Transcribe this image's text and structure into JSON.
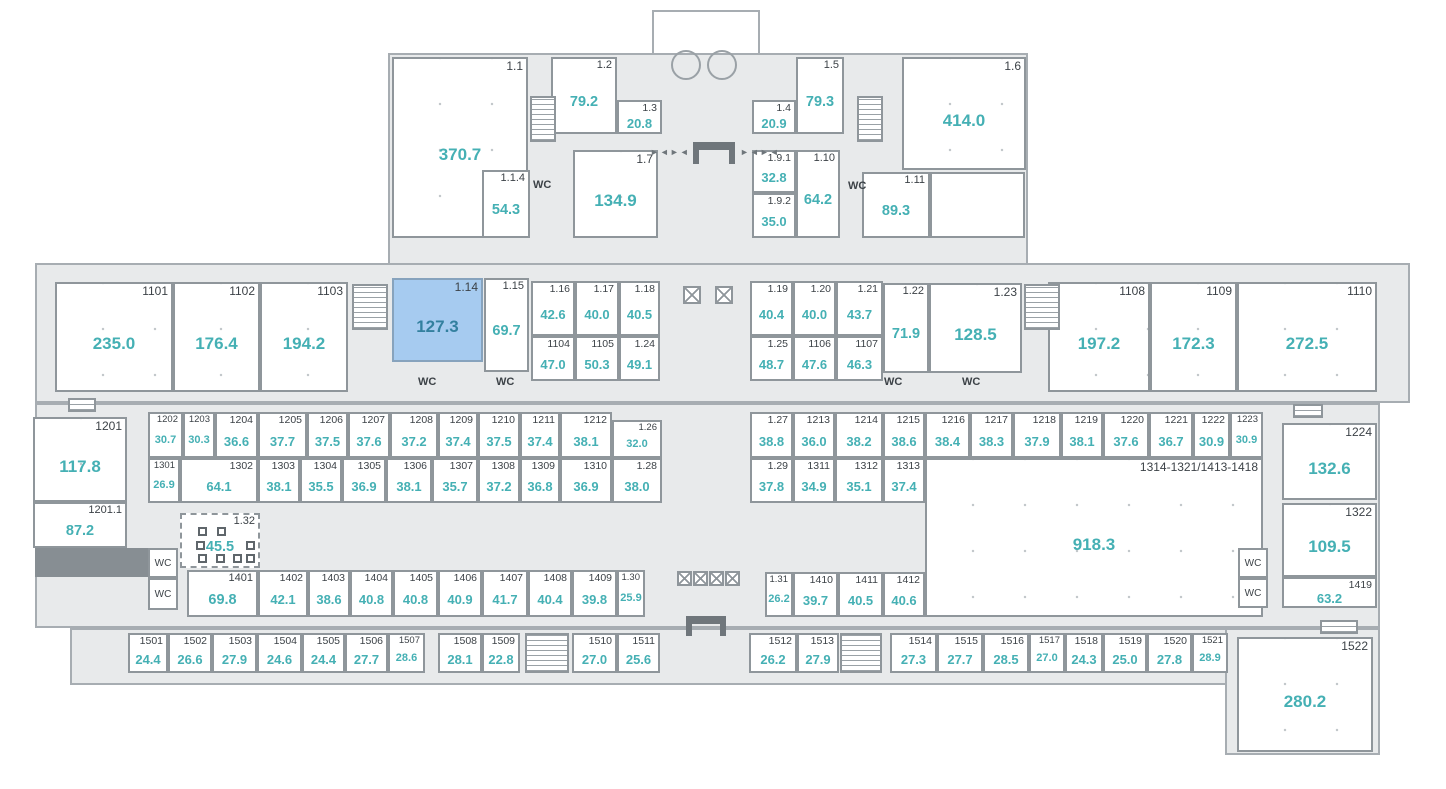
{
  "plan": {
    "title": "floor-plan",
    "colors": {
      "base_fill": "#e8eaeb",
      "wall": "#8f969b",
      "number": "#3c4247",
      "area": "#45b0b4",
      "highlight_fill": "#a6cbf0",
      "highlight_area": "#33809f"
    }
  },
  "base_shapes": [
    {
      "x": 652,
      "y": 10,
      "w": 108,
      "h": 45,
      "white": true
    },
    {
      "x": 388,
      "y": 53,
      "w": 640,
      "h": 212
    },
    {
      "x": 35,
      "y": 263,
      "w": 1375,
      "h": 140
    },
    {
      "x": 35,
      "y": 403,
      "w": 1345,
      "h": 225
    },
    {
      "x": 70,
      "y": 628,
      "w": 1310,
      "h": 57
    },
    {
      "x": 1225,
      "y": 628,
      "w": 155,
      "h": 127
    }
  ],
  "rooms": [
    {
      "id": "1.1",
      "area": "370.7",
      "x": 392,
      "y": 57,
      "w": 136,
      "h": 181,
      "cls": "lg"
    },
    {
      "id": "1.2",
      "area": "79.2",
      "x": 551,
      "y": 57,
      "w": 66,
      "h": 77,
      "cls": "md"
    },
    {
      "id": "1.3",
      "area": "20.8",
      "x": 617,
      "y": 100,
      "w": 45,
      "h": 34,
      "cls": "sm"
    },
    {
      "id": "1.4",
      "area": "20.9",
      "x": 752,
      "y": 100,
      "w": 44,
      "h": 34,
      "cls": "sm"
    },
    {
      "id": "1.5",
      "area": "79.3",
      "x": 796,
      "y": 57,
      "w": 48,
      "h": 77,
      "cls": "md"
    },
    {
      "id": "1.6",
      "area": "414.0",
      "x": 902,
      "y": 57,
      "w": 124,
      "h": 113,
      "cls": "lg"
    },
    {
      "id": "1.1.4",
      "area": "54.3",
      "x": 482,
      "y": 170,
      "w": 48,
      "h": 68,
      "cls": "md"
    },
    {
      "id": "1.7",
      "area": "134.9",
      "x": 573,
      "y": 150,
      "w": 85,
      "h": 88,
      "cls": "lg"
    },
    {
      "id": "1.9.1",
      "area": "32.8",
      "x": 752,
      "y": 150,
      "w": 44,
      "h": 43,
      "cls": "sm"
    },
    {
      "id": "1.9.2",
      "area": "35.0",
      "x": 752,
      "y": 193,
      "w": 44,
      "h": 45,
      "cls": "sm"
    },
    {
      "id": "1.10",
      "area": "64.2",
      "x": 796,
      "y": 150,
      "w": 44,
      "h": 88,
      "cls": "md"
    },
    {
      "id": "1.11",
      "area": "89.3",
      "x": 862,
      "y": 172,
      "w": 68,
      "h": 66,
      "cls": "md"
    },
    {
      "id": "1101",
      "area": "235.0",
      "x": 55,
      "y": 282,
      "w": 118,
      "h": 110,
      "cls": "lg"
    },
    {
      "id": "1102",
      "area": "176.4",
      "x": 173,
      "y": 282,
      "w": 87,
      "h": 110,
      "cls": "lg"
    },
    {
      "id": "1103",
      "area": "194.2",
      "x": 260,
      "y": 282,
      "w": 88,
      "h": 110,
      "cls": "lg"
    },
    {
      "id": "1.14",
      "area": "127.3",
      "x": 392,
      "y": 278,
      "w": 91,
      "h": 84,
      "cls": "lg",
      "hl": true
    },
    {
      "id": "1.15",
      "area": "69.7",
      "x": 484,
      "y": 278,
      "w": 45,
      "h": 94,
      "cls": "md"
    },
    {
      "id": "1.16",
      "area": "42.6",
      "x": 531,
      "y": 281,
      "w": 44,
      "h": 55,
      "cls": "sm"
    },
    {
      "id": "1.17",
      "area": "40.0",
      "x": 575,
      "y": 281,
      "w": 44,
      "h": 55,
      "cls": "sm"
    },
    {
      "id": "1.18",
      "area": "40.5",
      "x": 619,
      "y": 281,
      "w": 41,
      "h": 55,
      "cls": "sm"
    },
    {
      "id": "1104",
      "area": "47.0",
      "x": 531,
      "y": 336,
      "w": 44,
      "h": 45,
      "cls": "sm"
    },
    {
      "id": "1105",
      "area": "50.3",
      "x": 575,
      "y": 336,
      "w": 44,
      "h": 45,
      "cls": "sm"
    },
    {
      "id": "1.24",
      "area": "49.1",
      "x": 619,
      "y": 336,
      "w": 41,
      "h": 45,
      "cls": "sm"
    },
    {
      "id": "1.19",
      "area": "40.4",
      "x": 750,
      "y": 281,
      "w": 43,
      "h": 55,
      "cls": "sm"
    },
    {
      "id": "1.20",
      "area": "40.0",
      "x": 793,
      "y": 281,
      "w": 43,
      "h": 55,
      "cls": "sm"
    },
    {
      "id": "1.21",
      "area": "43.7",
      "x": 836,
      "y": 281,
      "w": 47,
      "h": 55,
      "cls": "sm"
    },
    {
      "id": "1.22",
      "area": "71.9",
      "x": 883,
      "y": 283,
      "w": 46,
      "h": 90,
      "cls": "md"
    },
    {
      "id": "1.23",
      "area": "128.5",
      "x": 929,
      "y": 283,
      "w": 93,
      "h": 90,
      "cls": "lg"
    },
    {
      "id": "1.25",
      "area": "48.7",
      "x": 750,
      "y": 336,
      "w": 43,
      "h": 45,
      "cls": "sm"
    },
    {
      "id": "1106",
      "area": "47.6",
      "x": 793,
      "y": 336,
      "w": 43,
      "h": 45,
      "cls": "sm"
    },
    {
      "id": "1107",
      "area": "46.3",
      "x": 836,
      "y": 336,
      "w": 47,
      "h": 45,
      "cls": "sm"
    },
    {
      "id": "1108",
      "area": "197.2",
      "x": 1048,
      "y": 282,
      "w": 102,
      "h": 110,
      "cls": "lg"
    },
    {
      "id": "1109",
      "area": "172.3",
      "x": 1150,
      "y": 282,
      "w": 87,
      "h": 110,
      "cls": "lg"
    },
    {
      "id": "1110",
      "area": "272.5",
      "x": 1237,
      "y": 282,
      "w": 140,
      "h": 110,
      "cls": "lg"
    },
    {
      "id": "1201",
      "area": "117.8",
      "x": 33,
      "y": 417,
      "w": 94,
      "h": 85,
      "cls": "lg"
    },
    {
      "id": "1201.1",
      "area": "87.2",
      "x": 33,
      "y": 502,
      "w": 94,
      "h": 46,
      "cls": "md"
    },
    {
      "id": "1202",
      "area": "30.7",
      "x": 148,
      "y": 412,
      "w": 35,
      "h": 46,
      "cls": "xs"
    },
    {
      "id": "1203",
      "area": "30.3",
      "x": 183,
      "y": 412,
      "w": 32,
      "h": 46,
      "cls": "xs"
    },
    {
      "id": "1204",
      "area": "36.6",
      "x": 215,
      "y": 412,
      "w": 43,
      "h": 46,
      "cls": "sm"
    },
    {
      "id": "1205",
      "area": "37.7",
      "x": 258,
      "y": 412,
      "w": 49,
      "h": 46,
      "cls": "sm"
    },
    {
      "id": "1206",
      "area": "37.5",
      "x": 307,
      "y": 412,
      "w": 41,
      "h": 46,
      "cls": "sm"
    },
    {
      "id": "1207",
      "area": "37.6",
      "x": 348,
      "y": 412,
      "w": 42,
      "h": 46,
      "cls": "sm"
    },
    {
      "id": "1208",
      "area": "37.2",
      "x": 390,
      "y": 412,
      "w": 48,
      "h": 46,
      "cls": "sm"
    },
    {
      "id": "1209",
      "area": "37.4",
      "x": 438,
      "y": 412,
      "w": 40,
      "h": 46,
      "cls": "sm"
    },
    {
      "id": "1210",
      "area": "37.5",
      "x": 478,
      "y": 412,
      "w": 42,
      "h": 46,
      "cls": "sm"
    },
    {
      "id": "1211",
      "area": "37.4",
      "x": 520,
      "y": 412,
      "w": 40,
      "h": 46,
      "cls": "sm"
    },
    {
      "id": "1212",
      "area": "38.1",
      "x": 560,
      "y": 412,
      "w": 52,
      "h": 46,
      "cls": "sm"
    },
    {
      "id": "1.26",
      "area": "32.0",
      "x": 612,
      "y": 420,
      "w": 50,
      "h": 38,
      "cls": "xs"
    },
    {
      "id": "1301",
      "area": "26.9",
      "x": 148,
      "y": 458,
      "w": 32,
      "h": 45,
      "cls": "xs"
    },
    {
      "id": "1302",
      "area": "64.1",
      "x": 180,
      "y": 458,
      "w": 78,
      "h": 45,
      "cls": "sm"
    },
    {
      "id": "1303",
      "area": "38.1",
      "x": 258,
      "y": 458,
      "w": 42,
      "h": 45,
      "cls": "sm"
    },
    {
      "id": "1304",
      "area": "35.5",
      "x": 300,
      "y": 458,
      "w": 42,
      "h": 45,
      "cls": "sm"
    },
    {
      "id": "1305",
      "area": "36.9",
      "x": 342,
      "y": 458,
      "w": 44,
      "h": 45,
      "cls": "sm"
    },
    {
      "id": "1306",
      "area": "38.1",
      "x": 386,
      "y": 458,
      "w": 46,
      "h": 45,
      "cls": "sm"
    },
    {
      "id": "1307",
      "area": "35.7",
      "x": 432,
      "y": 458,
      "w": 46,
      "h": 45,
      "cls": "sm"
    },
    {
      "id": "1308",
      "area": "37.2",
      "x": 478,
      "y": 458,
      "w": 42,
      "h": 45,
      "cls": "sm"
    },
    {
      "id": "1309",
      "area": "36.8",
      "x": 520,
      "y": 458,
      "w": 40,
      "h": 45,
      "cls": "sm"
    },
    {
      "id": "1310",
      "area": "36.9",
      "x": 560,
      "y": 458,
      "w": 52,
      "h": 45,
      "cls": "sm"
    },
    {
      "id": "1.28",
      "area": "38.0",
      "x": 612,
      "y": 458,
      "w": 50,
      "h": 45,
      "cls": "sm"
    },
    {
      "id": "1.27",
      "area": "38.8",
      "x": 750,
      "y": 412,
      "w": 43,
      "h": 46,
      "cls": "sm"
    },
    {
      "id": "1213",
      "area": "36.0",
      "x": 793,
      "y": 412,
      "w": 42,
      "h": 46,
      "cls": "sm"
    },
    {
      "id": "1214",
      "area": "38.2",
      "x": 835,
      "y": 412,
      "w": 48,
      "h": 46,
      "cls": "sm"
    },
    {
      "id": "1215",
      "area": "38.6",
      "x": 883,
      "y": 412,
      "w": 42,
      "h": 46,
      "cls": "sm"
    },
    {
      "id": "1216",
      "area": "38.4",
      "x": 925,
      "y": 412,
      "w": 45,
      "h": 46,
      "cls": "sm"
    },
    {
      "id": "1217",
      "area": "38.3",
      "x": 970,
      "y": 412,
      "w": 43,
      "h": 46,
      "cls": "sm"
    },
    {
      "id": "1218",
      "area": "37.9",
      "x": 1013,
      "y": 412,
      "w": 48,
      "h": 46,
      "cls": "sm"
    },
    {
      "id": "1219",
      "area": "38.1",
      "x": 1061,
      "y": 412,
      "w": 42,
      "h": 46,
      "cls": "sm"
    },
    {
      "id": "1220",
      "area": "37.6",
      "x": 1103,
      "y": 412,
      "w": 46,
      "h": 46,
      "cls": "sm"
    },
    {
      "id": "1221",
      "area": "36.7",
      "x": 1149,
      "y": 412,
      "w": 44,
      "h": 46,
      "cls": "sm"
    },
    {
      "id": "1222",
      "area": "30.9",
      "x": 1193,
      "y": 412,
      "w": 37,
      "h": 46,
      "cls": "sm"
    },
    {
      "id": "1223",
      "area": "30.9",
      "x": 1230,
      "y": 412,
      "w": 33,
      "h": 46,
      "cls": "xs"
    },
    {
      "id": "1.29",
      "area": "37.8",
      "x": 750,
      "y": 458,
      "w": 43,
      "h": 45,
      "cls": "sm"
    },
    {
      "id": "1311",
      "area": "34.9",
      "x": 793,
      "y": 458,
      "w": 42,
      "h": 45,
      "cls": "sm"
    },
    {
      "id": "1312",
      "area": "35.1",
      "x": 835,
      "y": 458,
      "w": 48,
      "h": 45,
      "cls": "sm"
    },
    {
      "id": "1313",
      "area": "37.4",
      "x": 883,
      "y": 458,
      "w": 42,
      "h": 45,
      "cls": "sm"
    },
    {
      "id": "1314-1321/1413-1418",
      "area": "918.3",
      "x": 925,
      "y": 458,
      "w": 338,
      "h": 159,
      "cls": "lg"
    },
    {
      "id": "1224",
      "area": "132.6",
      "x": 1282,
      "y": 423,
      "w": 95,
      "h": 77,
      "cls": "lg"
    },
    {
      "id": "1322",
      "area": "109.5",
      "x": 1282,
      "y": 503,
      "w": 95,
      "h": 74,
      "cls": "lg"
    },
    {
      "id": "1419",
      "area": "63.2",
      "x": 1282,
      "y": 577,
      "w": 95,
      "h": 31,
      "cls": "sm"
    },
    {
      "id": "1.32",
      "area": "45.5",
      "x": 180,
      "y": 513,
      "w": 80,
      "h": 55,
      "cls": "md",
      "dashed": true
    },
    {
      "id": "1401",
      "area": "69.8",
      "x": 187,
      "y": 570,
      "w": 71,
      "h": 47,
      "cls": "md"
    },
    {
      "id": "1402",
      "area": "42.1",
      "x": 258,
      "y": 570,
      "w": 50,
      "h": 47,
      "cls": "sm"
    },
    {
      "id": "1403",
      "area": "38.6",
      "x": 308,
      "y": 570,
      "w": 42,
      "h": 47,
      "cls": "sm"
    },
    {
      "id": "1404",
      "area": "40.8",
      "x": 350,
      "y": 570,
      "w": 43,
      "h": 47,
      "cls": "sm"
    },
    {
      "id": "1405",
      "area": "40.8",
      "x": 393,
      "y": 570,
      "w": 45,
      "h": 47,
      "cls": "sm"
    },
    {
      "id": "1406",
      "area": "40.9",
      "x": 438,
      "y": 570,
      "w": 44,
      "h": 47,
      "cls": "sm"
    },
    {
      "id": "1407",
      "area": "41.7",
      "x": 482,
      "y": 570,
      "w": 46,
      "h": 47,
      "cls": "sm"
    },
    {
      "id": "1408",
      "area": "40.4",
      "x": 528,
      "y": 570,
      "w": 44,
      "h": 47,
      "cls": "sm"
    },
    {
      "id": "1409",
      "area": "39.8",
      "x": 572,
      "y": 570,
      "w": 45,
      "h": 47,
      "cls": "sm"
    },
    {
      "id": "1.30",
      "area": "25.9",
      "x": 617,
      "y": 570,
      "w": 28,
      "h": 47,
      "cls": "xs"
    },
    {
      "id": "1.31",
      "area": "26.2",
      "x": 765,
      "y": 572,
      "w": 28,
      "h": 45,
      "cls": "xs"
    },
    {
      "id": "1410",
      "area": "39.7",
      "x": 793,
      "y": 572,
      "w": 45,
      "h": 45,
      "cls": "sm"
    },
    {
      "id": "1411",
      "area": "40.5",
      "x": 838,
      "y": 572,
      "w": 45,
      "h": 45,
      "cls": "sm"
    },
    {
      "id": "1412",
      "area": "40.6",
      "x": 883,
      "y": 572,
      "w": 42,
      "h": 45,
      "cls": "sm"
    },
    {
      "id": "1501",
      "area": "24.4",
      "x": 128,
      "y": 633,
      "w": 40,
      "h": 40,
      "cls": "sm"
    },
    {
      "id": "1502",
      "area": "26.6",
      "x": 168,
      "y": 633,
      "w": 44,
      "h": 40,
      "cls": "sm"
    },
    {
      "id": "1503",
      "area": "27.9",
      "x": 212,
      "y": 633,
      "w": 45,
      "h": 40,
      "cls": "sm"
    },
    {
      "id": "1504",
      "area": "24.6",
      "x": 257,
      "y": 633,
      "w": 45,
      "h": 40,
      "cls": "sm"
    },
    {
      "id": "1505",
      "area": "24.4",
      "x": 302,
      "y": 633,
      "w": 43,
      "h": 40,
      "cls": "sm"
    },
    {
      "id": "1506",
      "area": "27.7",
      "x": 345,
      "y": 633,
      "w": 43,
      "h": 40,
      "cls": "sm"
    },
    {
      "id": "1507",
      "area": "28.6",
      "x": 388,
      "y": 633,
      "w": 37,
      "h": 40,
      "cls": "xs"
    },
    {
      "id": "1508",
      "area": "28.1",
      "x": 438,
      "y": 633,
      "w": 44,
      "h": 40,
      "cls": "sm"
    },
    {
      "id": "1509",
      "area": "22.8",
      "x": 482,
      "y": 633,
      "w": 38,
      "h": 40,
      "cls": "sm"
    },
    {
      "id": "1510",
      "area": "27.0",
      "x": 572,
      "y": 633,
      "w": 45,
      "h": 40,
      "cls": "sm"
    },
    {
      "id": "1511",
      "area": "25.6",
      "x": 617,
      "y": 633,
      "w": 43,
      "h": 40,
      "cls": "sm"
    },
    {
      "id": "1512",
      "area": "26.2",
      "x": 749,
      "y": 633,
      "w": 48,
      "h": 40,
      "cls": "sm"
    },
    {
      "id": "1513",
      "area": "27.9",
      "x": 797,
      "y": 633,
      "w": 42,
      "h": 40,
      "cls": "sm"
    },
    {
      "id": "1514",
      "area": "27.3",
      "x": 890,
      "y": 633,
      "w": 47,
      "h": 40,
      "cls": "sm"
    },
    {
      "id": "1515",
      "area": "27.7",
      "x": 937,
      "y": 633,
      "w": 46,
      "h": 40,
      "cls": "sm"
    },
    {
      "id": "1516",
      "area": "28.5",
      "x": 983,
      "y": 633,
      "w": 46,
      "h": 40,
      "cls": "sm"
    },
    {
      "id": "1517",
      "area": "27.0",
      "x": 1029,
      "y": 633,
      "w": 36,
      "h": 40,
      "cls": "xs"
    },
    {
      "id": "1518",
      "area": "24.3",
      "x": 1065,
      "y": 633,
      "w": 38,
      "h": 40,
      "cls": "sm"
    },
    {
      "id": "1519",
      "area": "25.0",
      "x": 1103,
      "y": 633,
      "w": 44,
      "h": 40,
      "cls": "sm"
    },
    {
      "id": "1520",
      "area": "27.8",
      "x": 1147,
      "y": 633,
      "w": 45,
      "h": 40,
      "cls": "sm"
    },
    {
      "id": "1521",
      "area": "28.9",
      "x": 1192,
      "y": 633,
      "w": 36,
      "h": 40,
      "cls": "xs"
    },
    {
      "id": "1522",
      "area": "280.2",
      "x": 1237,
      "y": 637,
      "w": 136,
      "h": 115,
      "cls": "lg"
    }
  ],
  "deco_rects": [
    {
      "x": 930,
      "y": 172,
      "w": 95,
      "h": 66
    },
    {
      "x": 394,
      "y": 280,
      "w": 44,
      "h": 21
    }
  ],
  "wc": {
    "label": "WC",
    "boxed": [
      {
        "x": 148,
        "y": 548,
        "w": 30,
        "h": 30
      },
      {
        "x": 148,
        "y": 578,
        "w": 30,
        "h": 32
      },
      {
        "x": 1238,
        "y": 548,
        "w": 30,
        "h": 30
      },
      {
        "x": 1238,
        "y": 578,
        "w": 30,
        "h": 30
      }
    ],
    "labels": [
      {
        "x": 533,
        "y": 179
      },
      {
        "x": 848,
        "y": 180
      },
      {
        "x": 418,
        "y": 376
      },
      {
        "x": 496,
        "y": 376
      },
      {
        "x": 884,
        "y": 376
      },
      {
        "x": 962,
        "y": 376
      }
    ]
  },
  "stairs": [
    {
      "x": 530,
      "y": 96,
      "w": 26,
      "h": 46
    },
    {
      "x": 857,
      "y": 96,
      "w": 26,
      "h": 46
    },
    {
      "x": 352,
      "y": 284,
      "w": 36,
      "h": 46
    },
    {
      "x": 1024,
      "y": 284,
      "w": 36,
      "h": 46
    },
    {
      "x": 525,
      "y": 633,
      "w": 44,
      "h": 40
    },
    {
      "x": 840,
      "y": 633,
      "w": 42,
      "h": 40
    },
    {
      "x": 68,
      "y": 398,
      "w": 28,
      "h": 14
    },
    {
      "x": 1293,
      "y": 404,
      "w": 30,
      "h": 14
    },
    {
      "x": 1320,
      "y": 620,
      "w": 38,
      "h": 14
    }
  ],
  "elevators": [
    {
      "x": 683,
      "y": 286,
      "s": 18
    },
    {
      "x": 715,
      "y": 286,
      "s": 18
    },
    {
      "x": 677,
      "y": 571,
      "s": 15
    },
    {
      "x": 693,
      "y": 571,
      "s": 15
    },
    {
      "x": 709,
      "y": 571,
      "s": 15
    },
    {
      "x": 725,
      "y": 571,
      "s": 15
    }
  ],
  "entrances": [
    {
      "x": 693,
      "y": 142,
      "w": 42,
      "h": 22
    },
    {
      "x": 686,
      "y": 616,
      "w": 40,
      "h": 20
    }
  ],
  "door_glyphs": {
    "text": "►◄►◄",
    "items": [
      {
        "x": 650,
        "y": 148
      },
      {
        "x": 740,
        "y": 148
      }
    ]
  },
  "columns": [
    {
      "x": 671,
      "y": 50,
      "s": 30
    },
    {
      "x": 707,
      "y": 50,
      "s": 30
    }
  ],
  "dark_block": {
    "x": 35,
    "y": 548,
    "w": 113,
    "h": 29
  },
  "workstations": [
    {
      "x": 198,
      "y": 527
    },
    {
      "x": 217,
      "y": 527
    },
    {
      "x": 196,
      "y": 541
    },
    {
      "x": 246,
      "y": 541
    },
    {
      "x": 198,
      "y": 554
    },
    {
      "x": 216,
      "y": 554
    },
    {
      "x": 233,
      "y": 554
    },
    {
      "x": 246,
      "y": 554
    }
  ]
}
